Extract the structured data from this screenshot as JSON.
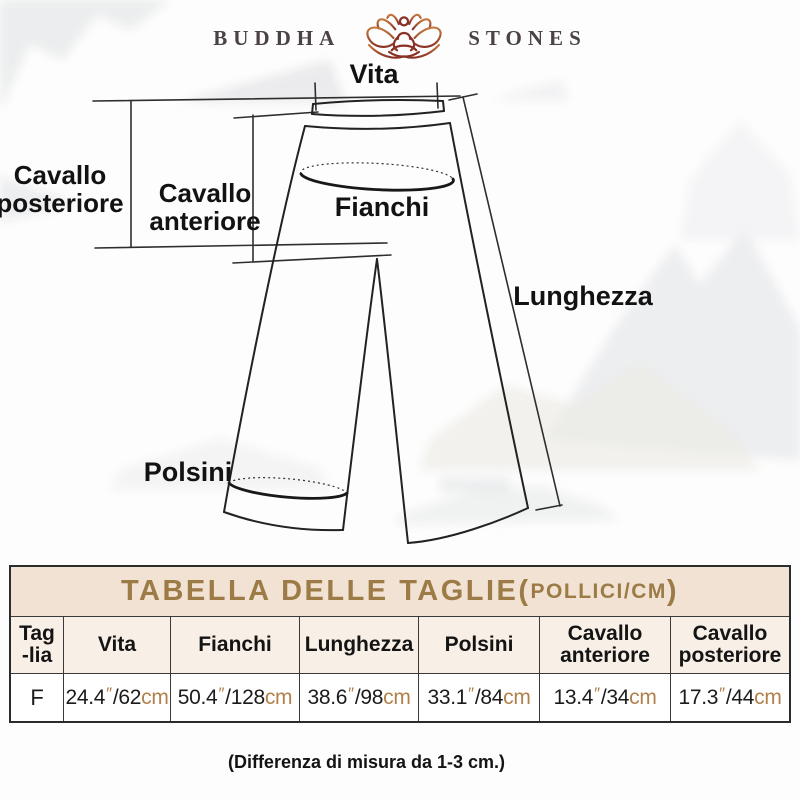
{
  "logo": {
    "brand_left": "BUDDHA",
    "brand_right": "STONES",
    "icon": "lotus-meditation-icon"
  },
  "diagram": {
    "labels": {
      "vita": "Vita",
      "cavallo_posteriore": "Cavallo\nposteriore",
      "cavallo_anteriore": "Cavallo\nanteriore",
      "fianchi": "Fianchi",
      "lunghezza": "Lunghezza",
      "polsini": "Polsini"
    }
  },
  "table": {
    "title_main": "TABELLA DELLE TAGLIE",
    "paren_open": "(",
    "title_unit": "POLLICI/CM",
    "paren_close": ")",
    "inch_mark": "″",
    "separator": "/",
    "cm_unit": "cm",
    "columns": [
      {
        "id": "taglia",
        "label": "Tag\n-lia"
      },
      {
        "id": "vita",
        "label": "Vita"
      },
      {
        "id": "fianchi",
        "label": "Fianchi"
      },
      {
        "id": "lunghezza",
        "label": "Lunghezza"
      },
      {
        "id": "polsini",
        "label": "Polsini"
      },
      {
        "id": "cavallo-anteriore",
        "label": "Cavallo\nanteriore"
      },
      {
        "id": "cavallo-posteriore",
        "label": "Cavallo\nposteriore"
      }
    ],
    "rows": [
      {
        "size": "F",
        "measures": [
          {
            "inches": "24.4",
            "cm": "62"
          },
          {
            "inches": "50.4",
            "cm": "128"
          },
          {
            "inches": "38.6",
            "cm": "98"
          },
          {
            "inches": "33.1",
            "cm": "84"
          },
          {
            "inches": "13.4",
            "cm": "34"
          },
          {
            "inches": "17.3",
            "cm": "44"
          }
        ]
      }
    ]
  },
  "note": "(Differenza di misura da 1-3 cm.)",
  "colors": {
    "accent_gold": "#9C7B46",
    "accent_brown": "#B1804B",
    "table_title_bg": "#F1E2D4",
    "table_header_bg": "#F8EFE7",
    "border_dark": "#2B2B2B",
    "line_color": "#222222",
    "logo_text": "#4A4245"
  }
}
